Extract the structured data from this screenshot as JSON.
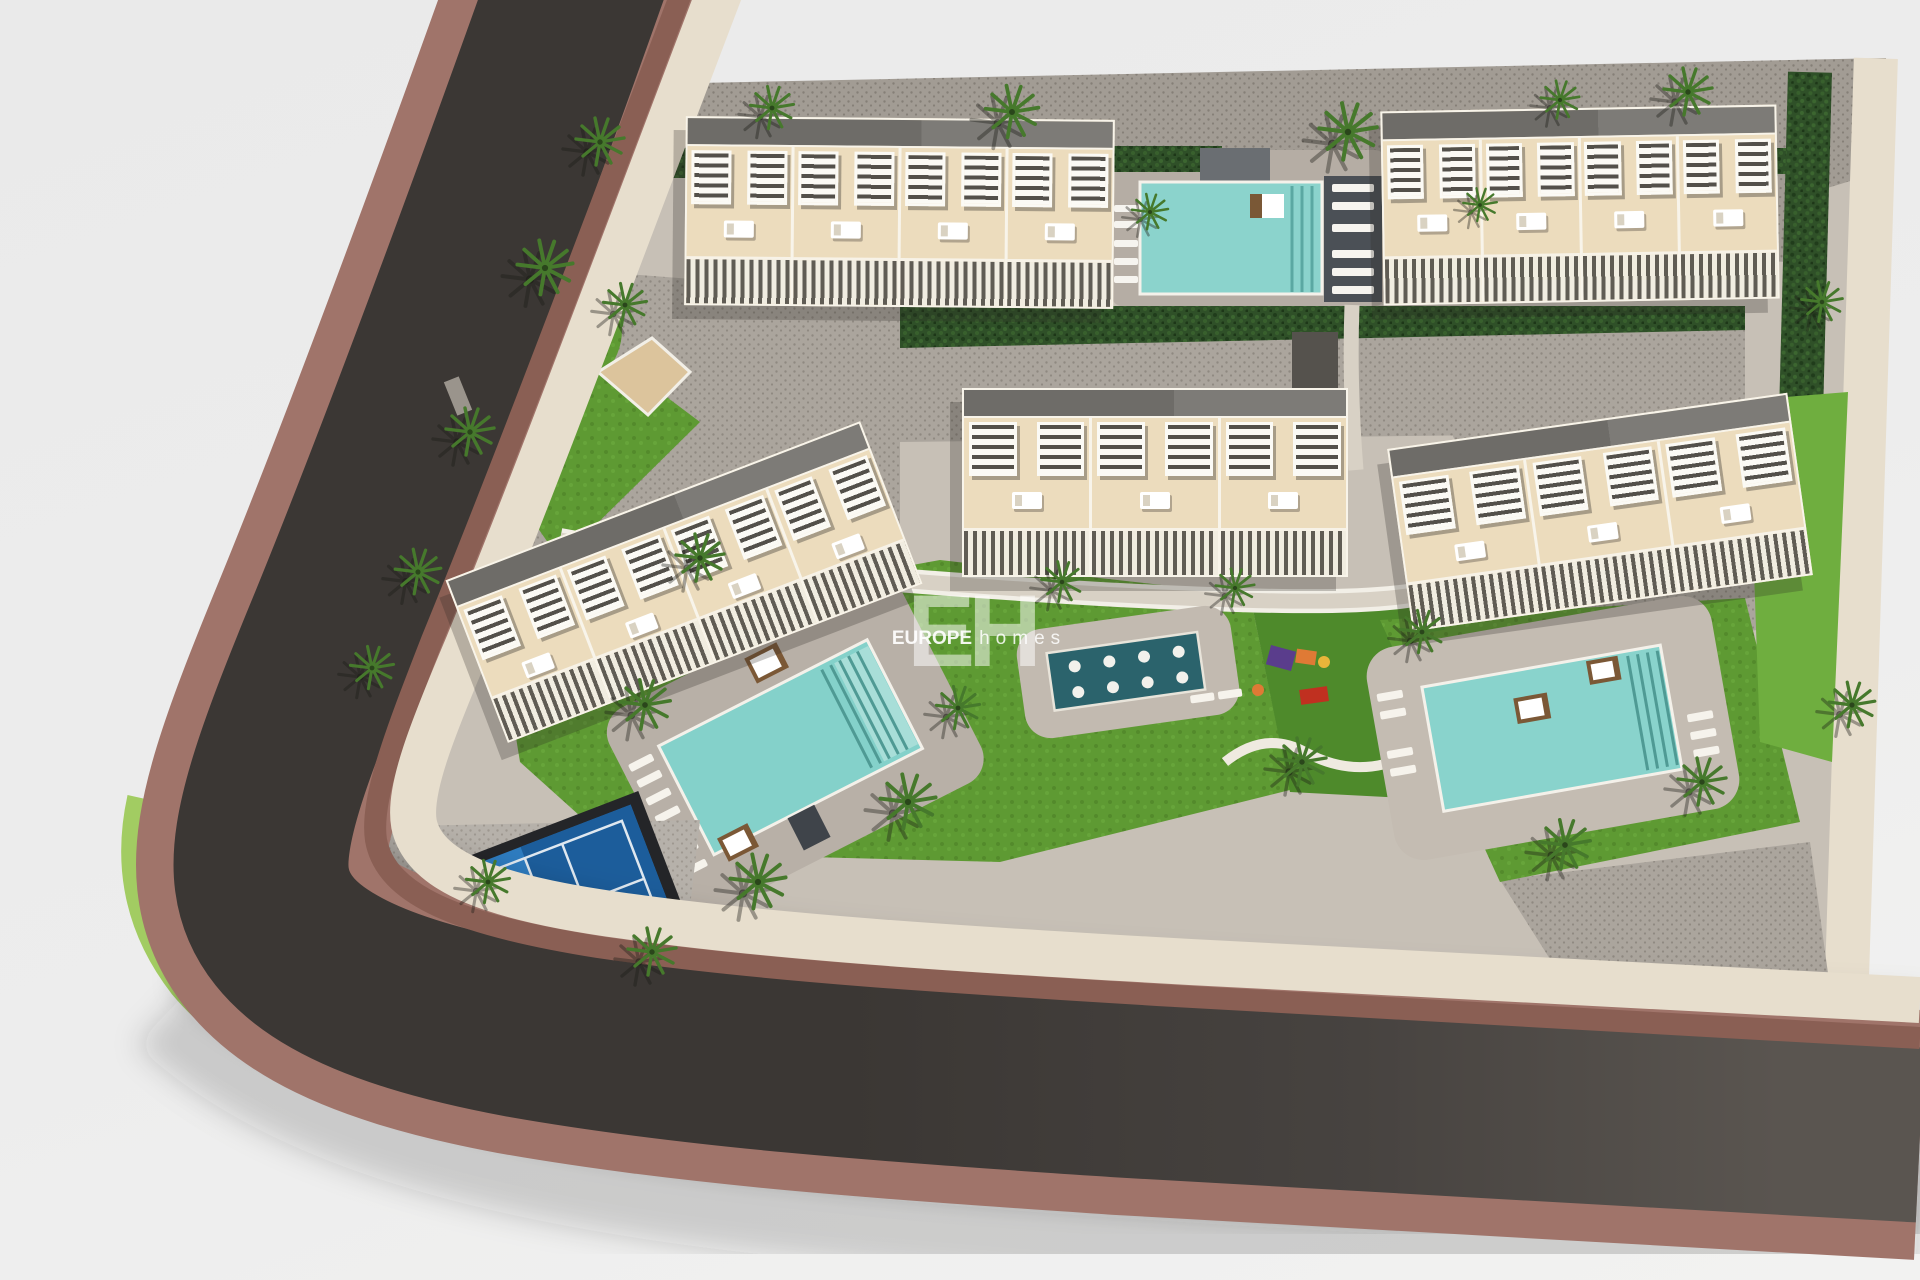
{
  "watermark": {
    "logo": "EH",
    "brand": "EUROPE",
    "brand_suffix": "homes"
  },
  "palette": {
    "background": "#ececec",
    "road_asphalt": "#3b3734",
    "road_sidewalk_outer": "#a0746a",
    "kerb_stripe": "#8a5f54",
    "sidewalk_inner": "#e7decd",
    "site_ground": "#c7c0b6",
    "pavers_light": "#aba59d",
    "pavers_dark": "#a29c94",
    "building_facade": "#ecdcbd",
    "building_roof": "#6e6c68",
    "pergola_white": "#fbfaf5",
    "hedge_green": "#2f5028",
    "lawn_green": "#5e9a33",
    "lawn_bright": "#6fae3f",
    "verge_light_green": "#a2cc62",
    "pool_water": "#89d3cc",
    "spa_water": "#2b636c",
    "court_blue": "#2e7cc0",
    "court_blue_shaded": "#1c5d9b",
    "splash_blue": "#1e6fb1",
    "accent_orange": "#df7a35",
    "accent_red": "#c03020",
    "accent_purple": "#5a3d8c",
    "accent_yellow": "#e8b53a"
  },
  "scene": {
    "description": "Aerial 3D architect rendering of a residential development: five townhouse blocks, three swimming pools, spa pool, playground, padel court and splash water park, bounded by a curving road.",
    "building_count": 5,
    "pool_count": 3,
    "buildings": [
      {
        "id": "block-north-west",
        "units": 4,
        "x": 685,
        "y": 118,
        "w": 425,
        "h": 185,
        "rot": 0.5
      },
      {
        "id": "block-north-east",
        "units": 4,
        "x": 1382,
        "y": 108,
        "w": 392,
        "h": 190,
        "rot": -1
      },
      {
        "id": "block-center",
        "units": 3,
        "x": 962,
        "y": 388,
        "w": 382,
        "h": 185,
        "rot": 0
      },
      {
        "id": "block-east",
        "units": 3,
        "x": 1398,
        "y": 420,
        "w": 400,
        "h": 180,
        "rot": -8
      },
      {
        "id": "block-west",
        "units": 4,
        "x": 462,
        "y": 495,
        "w": 440,
        "h": 170,
        "rot": -21
      }
    ],
    "palms": [
      [
        600,
        142,
        1.0
      ],
      [
        772,
        108,
        0.9
      ],
      [
        1012,
        112,
        1.1
      ],
      [
        1348,
        132,
        1.2
      ],
      [
        1688,
        92,
        1.0
      ],
      [
        1560,
        100,
        0.8
      ],
      [
        545,
        268,
        1.15
      ],
      [
        625,
        305,
        0.9
      ],
      [
        470,
        432,
        1.0
      ],
      [
        418,
        572,
        0.95
      ],
      [
        372,
        668,
        0.9
      ],
      [
        700,
        558,
        1.0
      ],
      [
        645,
        705,
        1.05
      ],
      [
        758,
        882,
        1.15
      ],
      [
        652,
        952,
        1.0
      ],
      [
        908,
        802,
        1.15
      ],
      [
        488,
        882,
        0.9
      ],
      [
        1062,
        582,
        0.85
      ],
      [
        1235,
        588,
        0.8
      ],
      [
        1302,
        762,
        1.0
      ],
      [
        1422,
        632,
        0.9
      ],
      [
        958,
        708,
        0.9
      ],
      [
        1150,
        212,
        0.75
      ],
      [
        1565,
        845,
        1.05
      ],
      [
        1702,
        782,
        1.0
      ],
      [
        1852,
        705,
        0.95
      ],
      [
        1822,
        302,
        0.85
      ],
      [
        1480,
        205,
        0.7
      ]
    ],
    "amenities": [
      "north swimming pool",
      "main swimming pool",
      "east swimming pool",
      "spa / kids pool",
      "children playground",
      "padel court",
      "splash water park",
      "paver plaza",
      "parking strip"
    ]
  }
}
